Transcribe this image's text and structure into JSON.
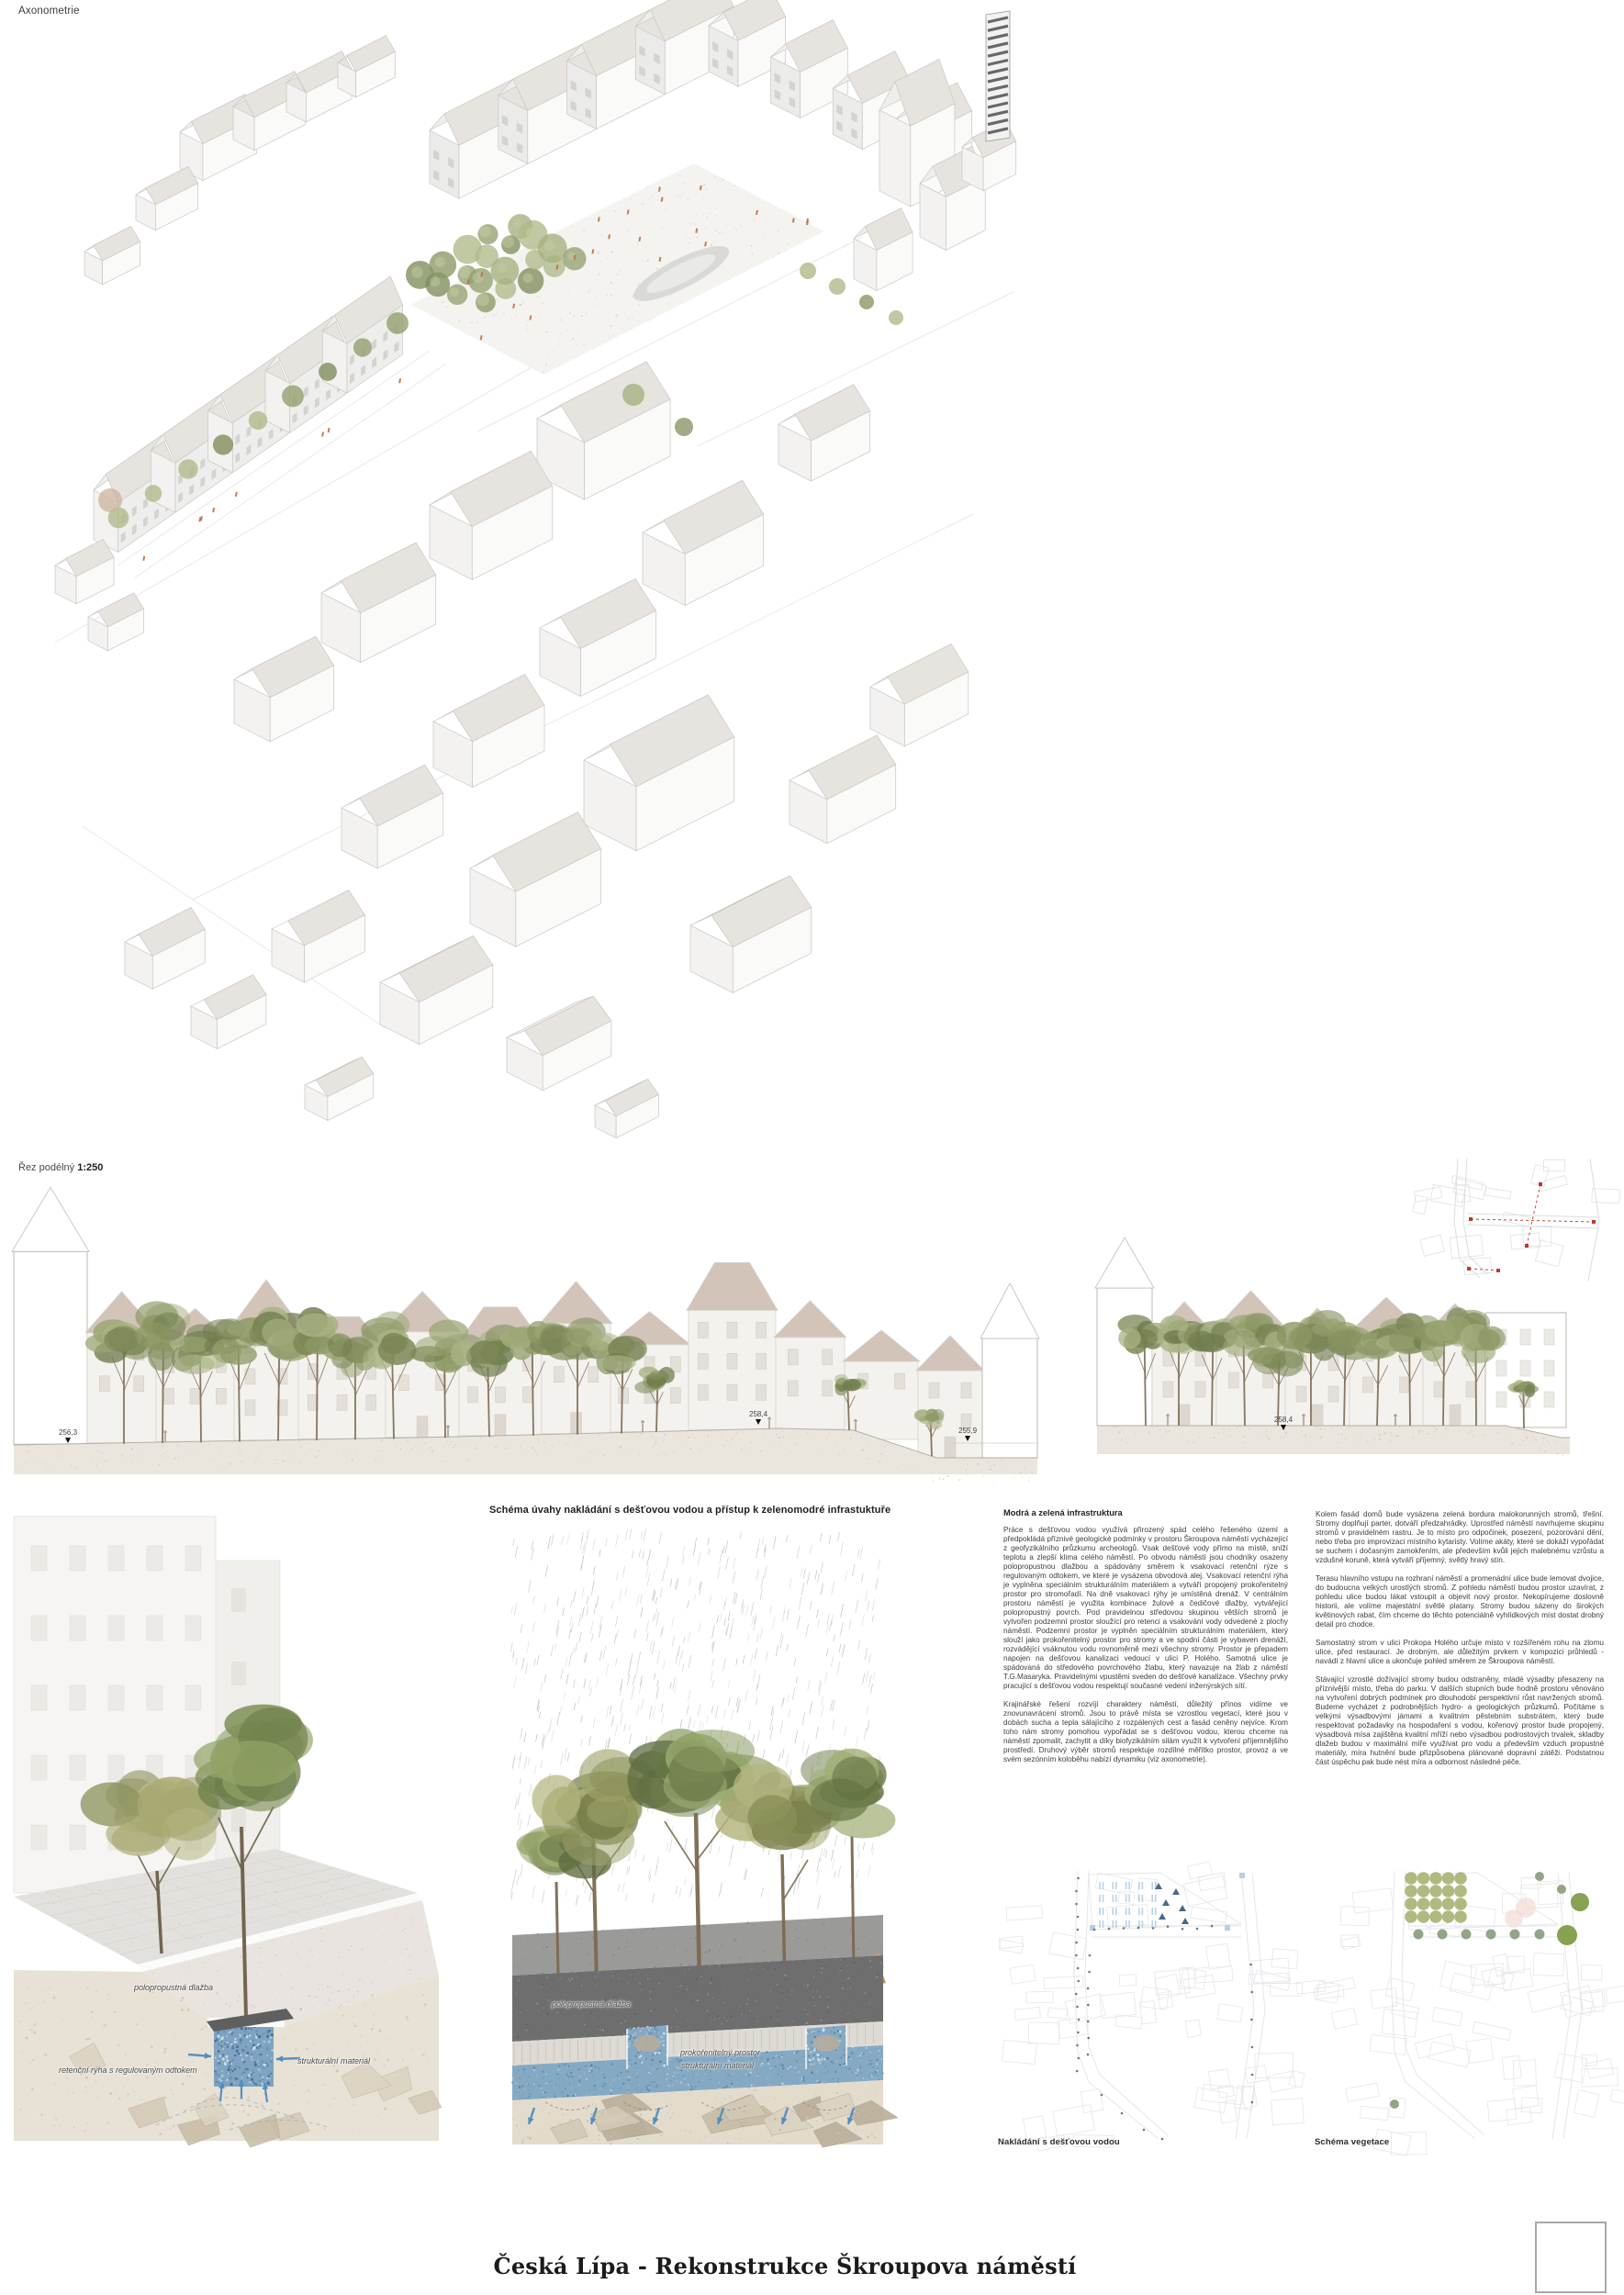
{
  "board": {
    "axon_label": "Axonometrie",
    "section_label": "Řez podélný",
    "section_scale": "1:250",
    "schema_heading": "Schéma úvahy nakládání s dešťovou vodou a přístup k zelenomodré infrastuktuře",
    "title": "Česká Lípa - Rekonstrukce Škroupova náměstí"
  },
  "markers": [
    {
      "value": "256,3"
    },
    {
      "value": "258,4"
    },
    {
      "value": "255,9"
    },
    {
      "value": "258,4"
    }
  ],
  "columns": {
    "col1": {
      "heading": "Modrá a zelená infrastruktura",
      "paragraphs": [
        "Práce s dešťovou vodou využívá přirozený spád celého řešeného území a předpokládá příznivé geologické podmínky v prostoru Škroupova náměstí vycházející z geofyzikálního průzkumu archeologů. Vsak dešťové vody přímo na místě, sníží teplotu a zlepší klima celého náměstí. Po obvodu náměstí jsou chodníky osazeny polopropustnou dlažbou a spádovány směrem k vsakovací retenční rýze s regulovaným odtokem, ve které je vysázena obvodová alej. Vsakovací retenční rýha je vyplněna speciálním strukturálním materiálem a vytváří propojený prokořenitelný prostor pro stromořadí. Na dně vsakovací rýhy je umístěná drenáž. V centrálním prostoru náměstí je využita kombinace žulové a čedičové dlažby, vytvářející polopropustný povrch. Pod pravidelnou středovou skupinou větších stromů je vytvořen podzemní prostor sloužící pro retenci a vsakování vody odvedené z plochy náměstí. Podzemní prostor je vyplněn speciálním strukturálním materiálem, který slouží jako prokořenitelný prostor pro stromy a ve spodní části je vybaven drenáží, rozvádějící vsáknutou vodu rovnoměrně mezi všechny stromy. Prostor je přepadem napojen na dešťovou kanalizaci vedoucí v ulici P. Holého. Samotná ulice je spádovaná do středového povrchového žlabu, který navazuje na žlab z náměstí T.G.Masaryka. Pravidelnými vpustěmi sveden do dešťové kanalizace. Všechny prvky pracující s dešťovou vodou respektují současné vedení inženýrských sítí.",
        "Krajinářské řešení rozvíjí charaktery náměstí, důležitý přínos vidíme ve znovunavrácení stromů. Jsou to právě místa se vzrostlou vegetací, které jsou v dobách sucha a tepla sálajícího z rozpálených cest a fasád ceněny nejvíce. Krom toho nám stromy pomohou vypořádat se s dešťovou vodou, kterou chceme na náměstí zpomalit, zachytit a díky biofyzikálním silám využít k vytvoření příjemnějšího prostředí. Druhový výběr stromů respektuje rozdílné měřítko prostor, provoz a ve svém sezónním koloběhu nabízí dynamiku (viz axonometrie)."
      ]
    },
    "col2": {
      "paragraphs": [
        "Kolem fasád domů bude vysázena zelená bordura malokorunných stromů, třešní. Stromy doplňují parter, dotváří předzahrádky. Uprostřed náměstí navrhujeme skupinu stromů v pravidelném rastru. Je to místo pro odpočinek, posezení, pozorování dění, nebo třeba pro improvizaci místního kytaristy. Volíme akáty, které se dokáží vypořádat se suchem i dočasným zamokřením, ale především kvůli jejich malebnému vzrůstu a vzdušné koruně, která vytváří příjemný, světlý hravý stín.",
        "Terasu hlavního vstupu na rozhraní náměstí a promenádní ulice bude lemovat dvojice, do budoucna velkých urostlých stromů. Z pohledu náměstí budou prostor uzavírat, z pohledu ulice budou lákat vstoupit a objevit nový prostor. Nekopírujeme doslovně historii, ale volíme majestátní světlé platany. Stromy budou sázeny do širokých květinových rabat, čím chceme do těchto potenciálně vyhlídkových míst dostat drobný detail pro chodce.",
        "Samostatný strom v ulici Prokopa Holého určuje místo v rozšířeném rohu na zlomu ulice, před restaurací. Je drobným, ale důležitým prvkem v kompozici průhledů - navádí z hlavní ulice a ukončuje pohled směrem ze Škroupova náměstí.",
        "Stávající vzrostlé dožívající stromy budou odstraněny, mladé výsadby přesazeny na příznivější místo, třeba do parku. V dalších stupních bude hodně prostoru věnováno na vytvoření dobrých podmínek pro dlouhodobí perspektivní růst navržených stromů. Budeme vycházet z podrobnějších hydro- a geologických průzkumů. Počítáme s velkými výsadbovými jámami a kvalitním pěstebním substrátem, který bude respektovat požadavky na hospodaření s vodou, kořenový prostor bude propojený, výsadbová mísa zajištěna kvalitní mříží nebo výsadbou podrostových trvalek, skladby dlažeb budou v maximální míře využívat pro vodu a především vzduch propustné materiály, míra hutnění bude přizpůsobena plánované dopravní zátěži. Podstatnou část úspěchu pak bude nést míra a odbornost následné péče."
      ]
    }
  },
  "labels": {
    "left": {
      "paving": "polopropustná dlažba",
      "trench": "retenční rýha s regulovaným odtokem",
      "structural": "strukturální materiál"
    },
    "middle": {
      "paving": "polopropustná dlažba",
      "root": "prokořenitelný prostor",
      "structural": "strukturální materiál"
    }
  },
  "diagrams": {
    "water": "Nakládání s dešťovou vodou",
    "vegetation": "Schéma vegetace"
  },
  "colors": {
    "blue_accent": "#4f8ec2",
    "blue_layer": "#85a9c2",
    "tree_olive": "#93a06f",
    "tree_green": "#7d8f55",
    "figure_orange": "#c0714a",
    "section_roof": "#d2c4b8",
    "red_section_line": "#c0392b",
    "paving_dark": "#6e6e6e"
  }
}
